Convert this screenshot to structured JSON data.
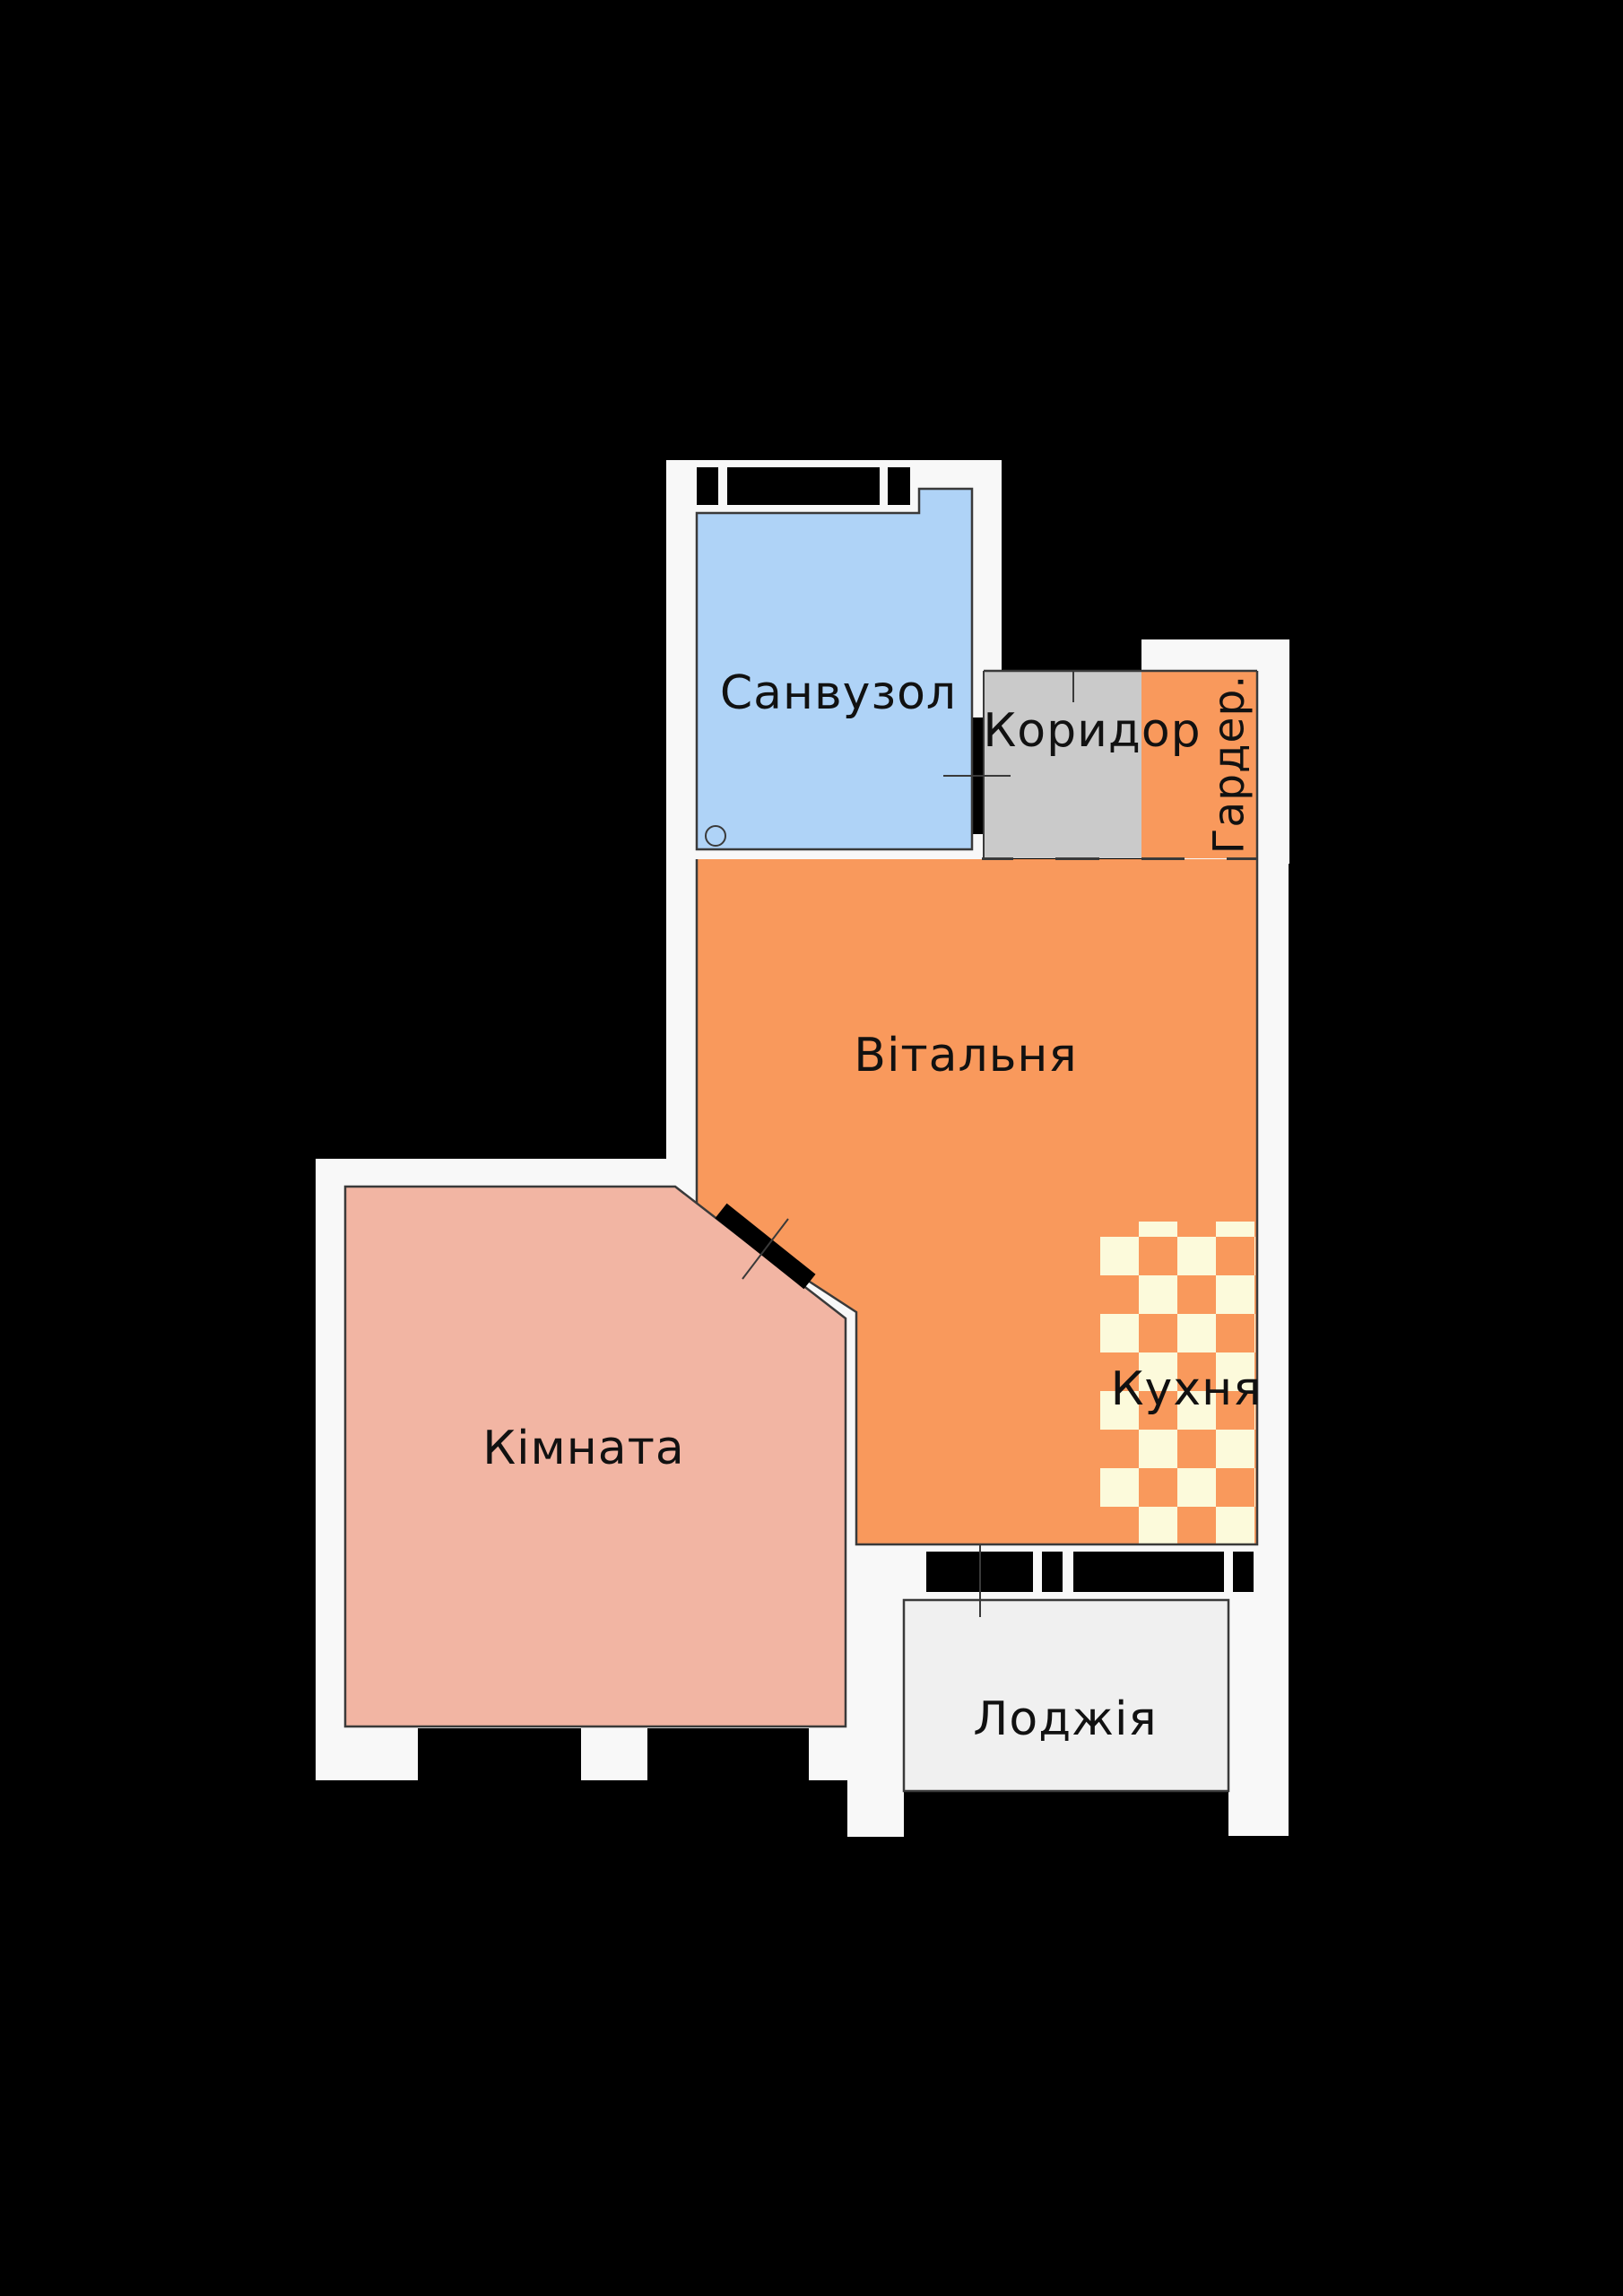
{
  "title": "Apartment floor plan",
  "rooms": {
    "bathroom": {
      "label": "Санвузол"
    },
    "corridor": {
      "label": "Коридор"
    },
    "wardrobe": {
      "label": "Гардер."
    },
    "living": {
      "label": "Вітальня"
    },
    "kitchen": {
      "label": "Кухня"
    },
    "bedroom": {
      "label": "Кімната"
    },
    "loggia": {
      "label": "Лоджія"
    }
  },
  "colors": {
    "canvas": "#000000",
    "panel": "#F8F8F8",
    "line": "#3A3A3A",
    "wall": "#000000",
    "bathroom": "#AFD3F7",
    "corridor": "#CACACA",
    "accent_orange": "#F9995C",
    "kitchen_cream": "#FCFADB",
    "bedroom_pink": "#F2B5A3",
    "loggia": "#F0F0F0",
    "label": "#111111"
  }
}
